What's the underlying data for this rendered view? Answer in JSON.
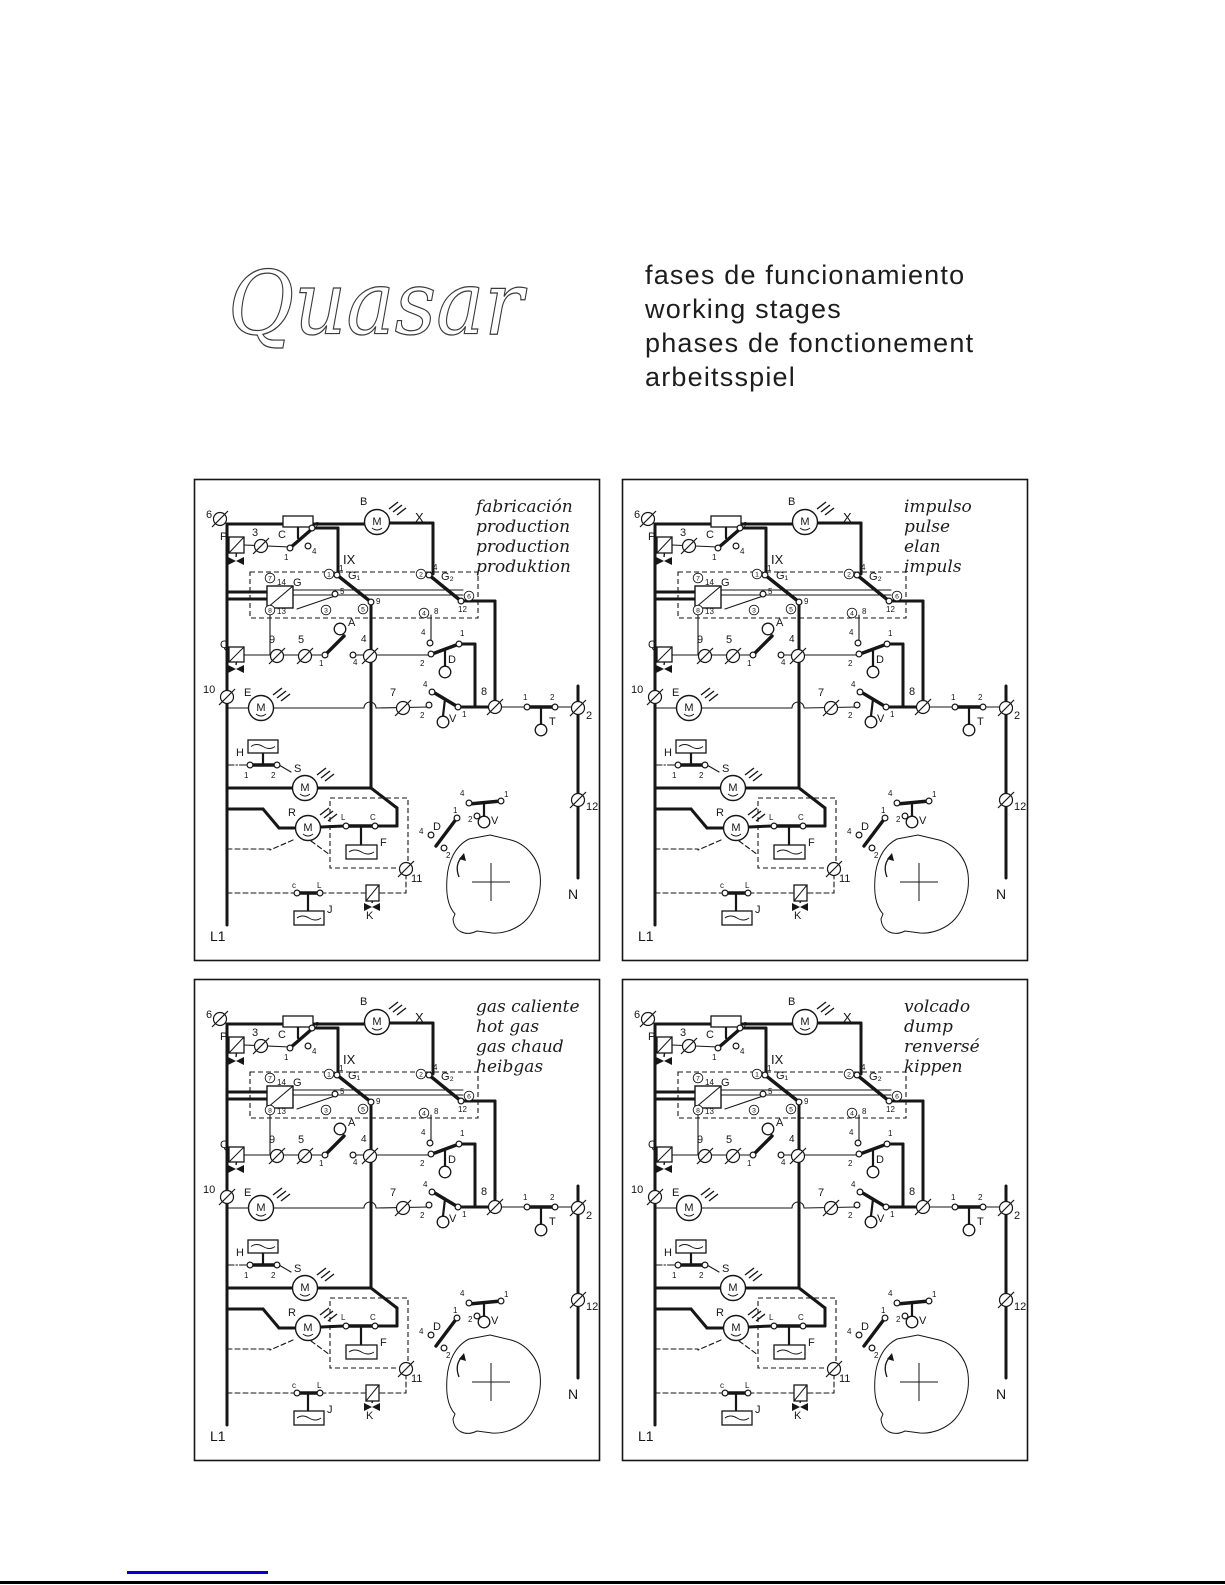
{
  "header": {
    "logo_text": "Quasar",
    "title_lines": [
      "fases de funcionamiento",
      "working stages",
      "phases de fonctionement",
      "arbeitsspiel"
    ]
  },
  "panels": [
    {
      "name": "fabricacion",
      "title_lines": [
        "fabricación",
        "production",
        "production",
        "produktion"
      ]
    },
    {
      "name": "impulso",
      "title_lines": [
        "impulso",
        "pulse",
        "elan",
        "impuls"
      ]
    },
    {
      "name": "gas-caliente",
      "title_lines": [
        "gas caliente",
        "hot gas",
        "gas chaud",
        "heibgas"
      ]
    },
    {
      "name": "volcado",
      "title_lines": [
        "volcado",
        "dump",
        "renversé",
        "kippen"
      ]
    }
  ],
  "schematic": {
    "labels": {
      "l6": "6",
      "lP": "P",
      "l3": "3",
      "lC": "C",
      "c_2": "2",
      "c_4": "4",
      "c_1": "1",
      "lIX": "IX",
      "lB": "B",
      "lM": "M",
      "lX": "X",
      "t7": "7",
      "t8": "8",
      "t1": "1",
      "t3": "3",
      "t5": "5",
      "t2": "2",
      "t4": "4",
      "t6": "6",
      "l14": "14",
      "lG": "G",
      "l13": "13",
      "g1": "G₁",
      "g1_1": "1",
      "g1_5": "5",
      "g1_9": "9",
      "g2": "G₂",
      "g2_4": "4",
      "g2_12": "12",
      "g2_8": "8",
      "lQ": "Q",
      "l9": "9",
      "l5": "5",
      "lA": "A",
      "a_1": "1",
      "a_4": "4",
      "l4": "4",
      "d_4": "4",
      "d_1": "1",
      "d_2": "2",
      "lD": "D",
      "l10": "10",
      "lE": "E",
      "l7": "7",
      "v_4": "4",
      "v_2": "2",
      "v_1": "1",
      "lV": "V",
      "l8": "8",
      "tt_1": "1",
      "tt_2": "2",
      "lT": "T",
      "l2": "2",
      "l12": "12",
      "lN": "N",
      "lH": "H",
      "h_1": "1",
      "h_2": "2",
      "lS": "S",
      "lR": "R",
      "lL": "L",
      "lCc": "C",
      "lF": "F",
      "l11": "11",
      "j_c": "c",
      "j_l": "L",
      "lJ": "J",
      "lK": "K",
      "cd": "D",
      "cd_1": "1",
      "cd_4": "4",
      "cd_2": "2",
      "cv": "V",
      "cv_4": "4",
      "cv_1": "1",
      "cv_2": "2",
      "lL1": "L1"
    }
  },
  "footer": {
    "link_bar_color": "#0000cc"
  }
}
